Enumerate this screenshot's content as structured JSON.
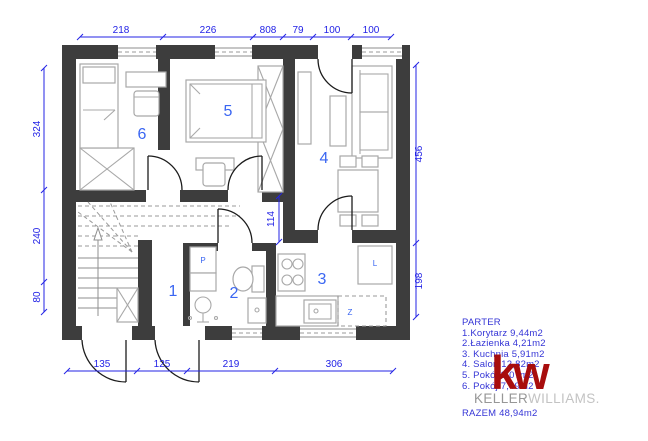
{
  "drawing": {
    "type": "floor-plan",
    "floor_label": "PARTER"
  },
  "dimensions": {
    "top": [
      "218",
      "226",
      "808",
      "79",
      "100",
      "100"
    ],
    "left": [
      "324",
      "240",
      "80"
    ],
    "right": [
      "456",
      "198"
    ],
    "bottom": [
      "135",
      "125",
      "219",
      "306"
    ],
    "interior_wall": "114"
  },
  "rooms": [
    {
      "number": "1",
      "name": "Korytarz"
    },
    {
      "number": "2",
      "name": "Łazienka"
    },
    {
      "number": "3",
      "name": "Kuchnia"
    },
    {
      "number": "4",
      "name": "Salon"
    },
    {
      "number": "5",
      "name": "Pokój"
    },
    {
      "number": "6",
      "name": "Pokój"
    }
  ],
  "appliance_labels": {
    "washing_machine": "P",
    "fridge": "L",
    "dishwasher": "Z"
  },
  "legend": {
    "title": "PARTER",
    "items": [
      "1.Korytarz 9,44m2",
      "2.Łazienka 4,21m2",
      "3. Kuchnia 5,91m2",
      "4. Salon 12,82m2",
      "5. Pokój 9,07m2",
      "6. Pokój 7,49m2"
    ],
    "total": "RAZEM 48,94m2"
  },
  "logo": {
    "monogram": "kw",
    "brand_primary": "KELLER",
    "brand_secondary": "WILLIAMS."
  },
  "colors": {
    "wall": "#3d3d3d",
    "dimension_blue": "#2323e6",
    "room_number_blue": "#3a66f2",
    "legend_blue": "#3535d6",
    "logo_red": "#a80d0d",
    "furniture_gray": "#a8a8a8"
  }
}
